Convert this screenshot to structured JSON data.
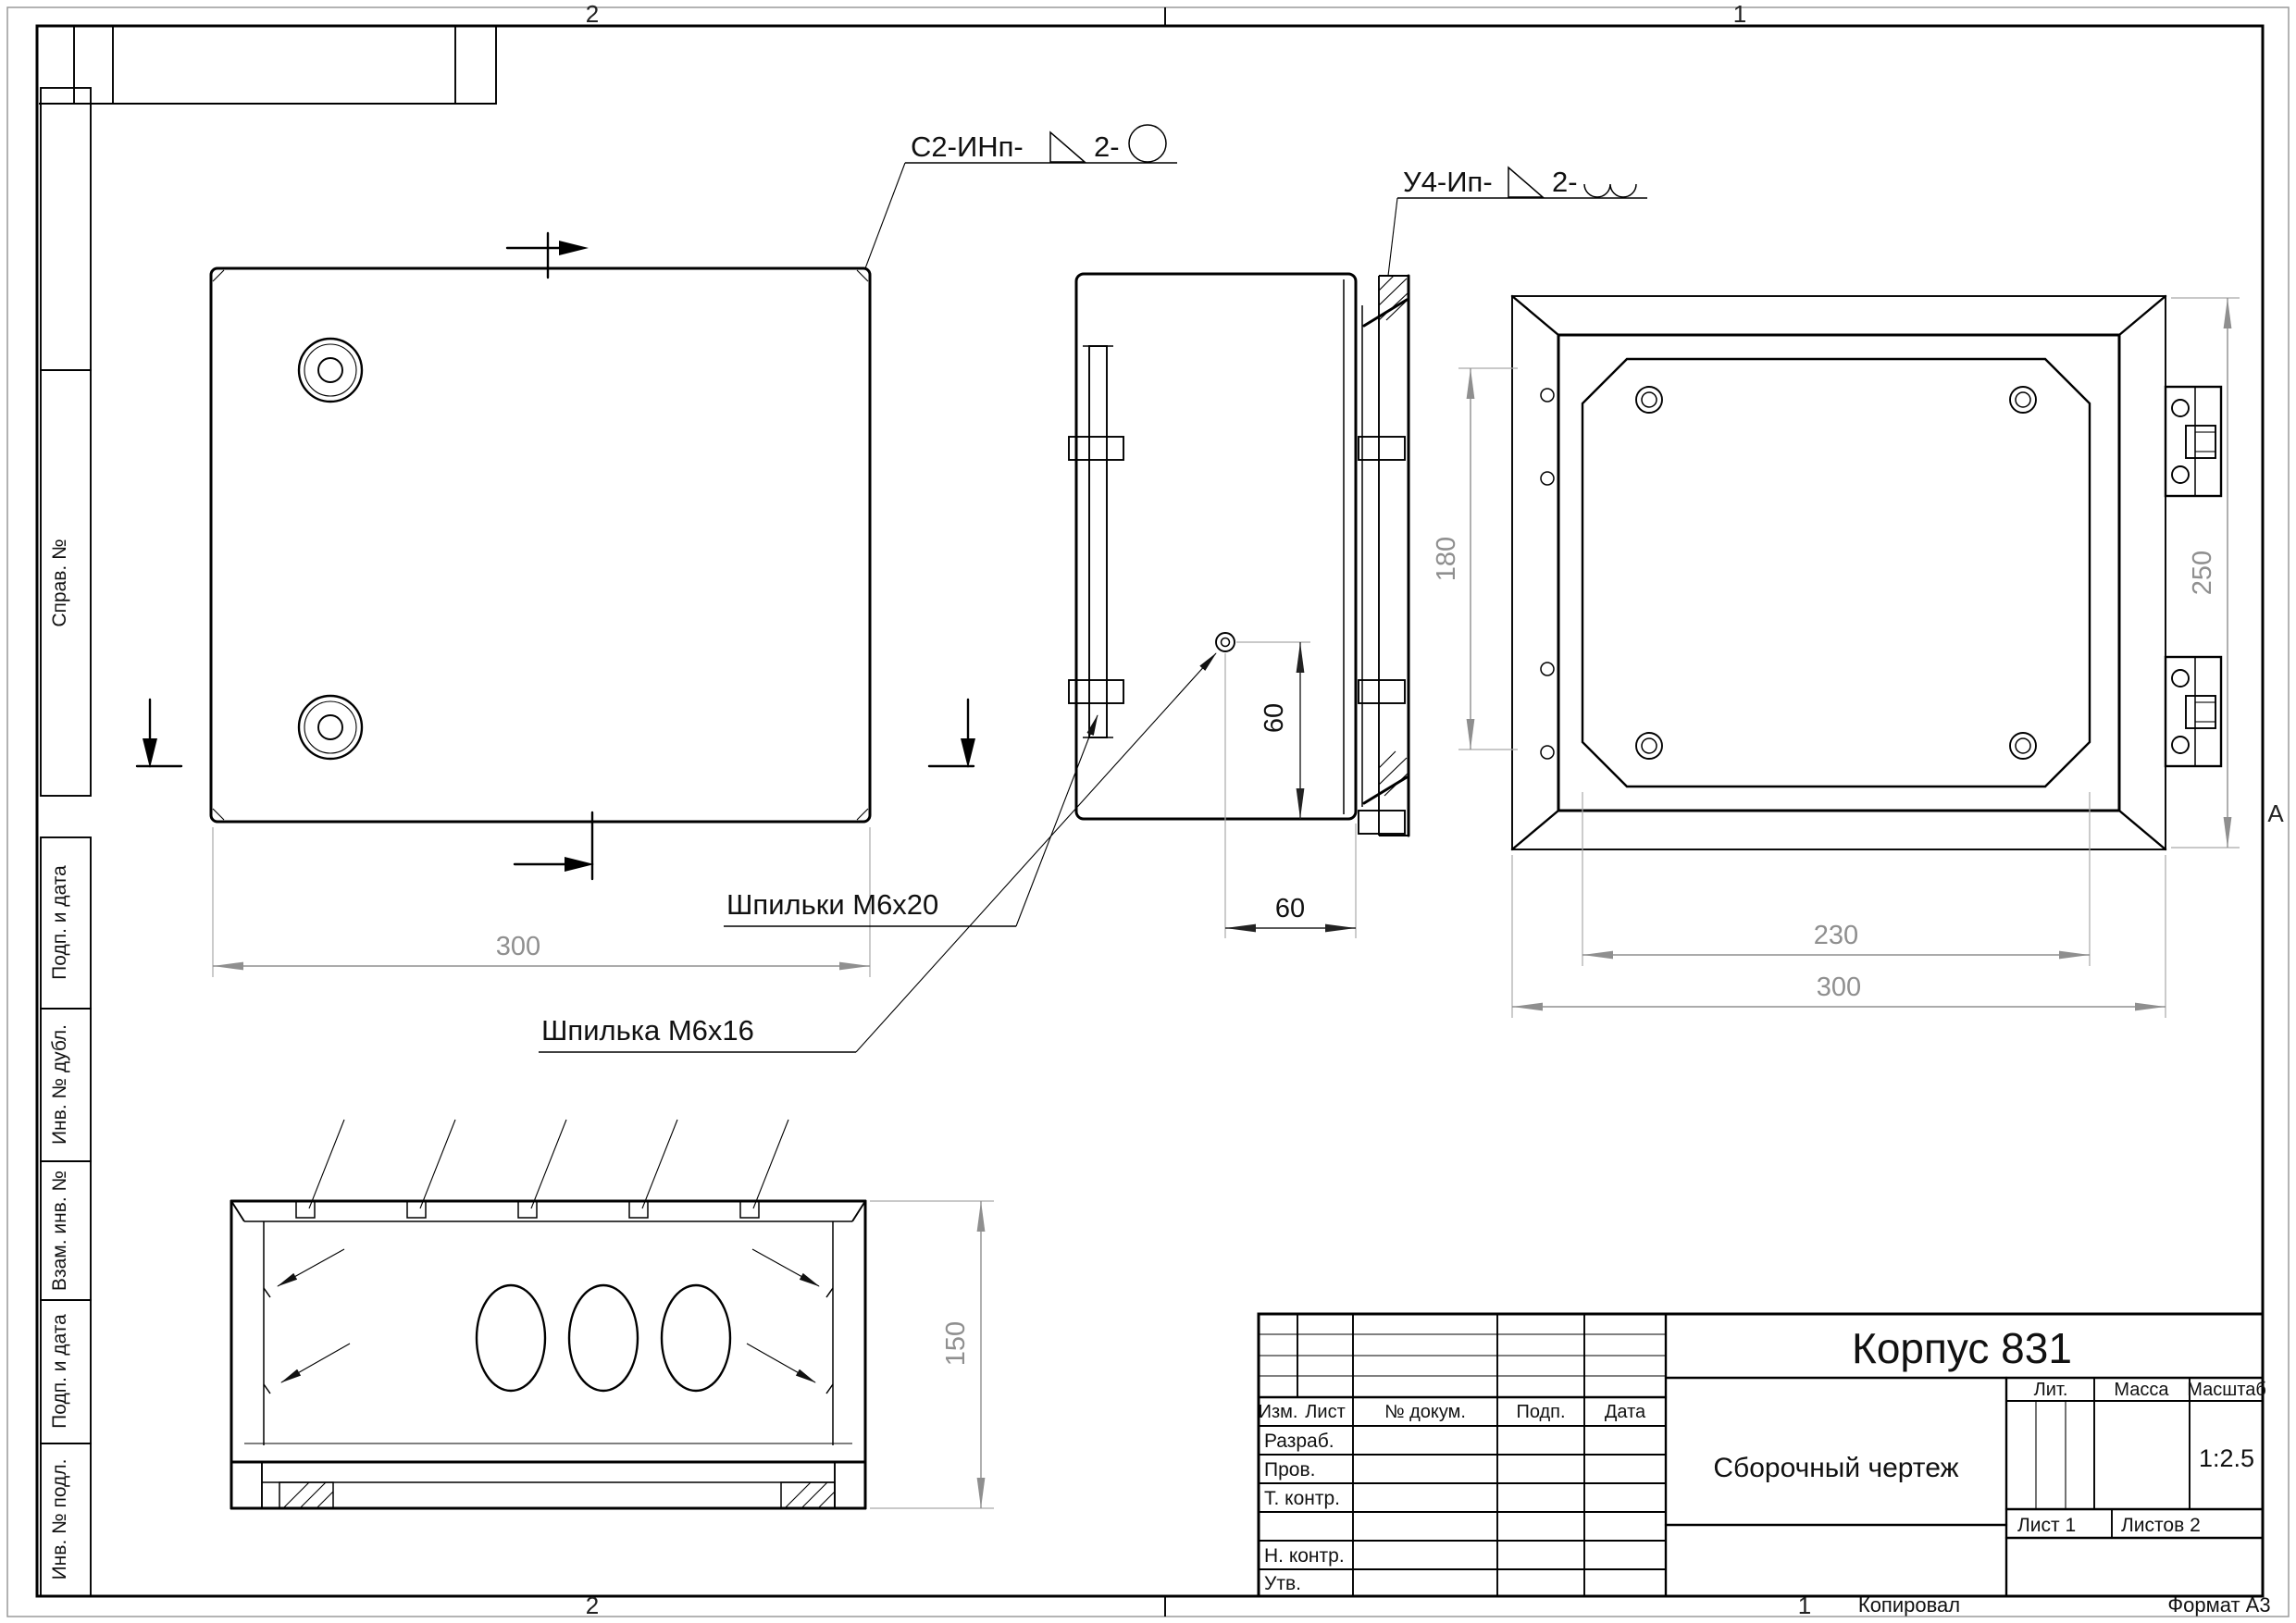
{
  "sheet": {
    "zones": {
      "top_2": "2",
      "top_1": "1",
      "bottom_2": "2",
      "bottom_1": "1",
      "right_a": "А"
    },
    "footer": {
      "kopiroval": "Копировал",
      "format": "Формат А3"
    },
    "margin_labels": [
      "Справ. №",
      "Подп. и дата",
      "Инв. № дубл.",
      "Взам. инв. №",
      "Подп. и дата",
      "Инв. № подл."
    ]
  },
  "title_block": {
    "title": "Корпус  831",
    "doc_type": "Сборочный чертеж",
    "scale_value": "1:2.5",
    "sheet_info": "Лист 1",
    "sheets_info": "Листов 2",
    "labels": {
      "izm": "Изм.",
      "list": "Лист",
      "doc_num": "№ докум.",
      "podp": "Подп.",
      "data": "Дата",
      "razrab": "Разраб.",
      "prov": "Пров.",
      "t_kontr": "Т. контр.",
      "n_kontr": "Н. контр.",
      "utv": "Утв.",
      "lit": "Лит.",
      "massa": "Масса",
      "masshtab": "Масштаб"
    }
  },
  "annotations": {
    "weld_1_prefix": "С2-ИНп-",
    "weld_1_qty": "2-",
    "weld_2_prefix": "У4-Ип-",
    "weld_2_qty": "2-",
    "studs_label": "Шпильки М6х20",
    "stud_label": "Шпилька М6х16"
  },
  "dimensions": {
    "square_width": "300",
    "stud_v": "60",
    "stud_h": "60",
    "front_inner_h": "180",
    "front_h": "250",
    "front_inner_w": "230",
    "front_w": "300",
    "depth": "150"
  }
}
